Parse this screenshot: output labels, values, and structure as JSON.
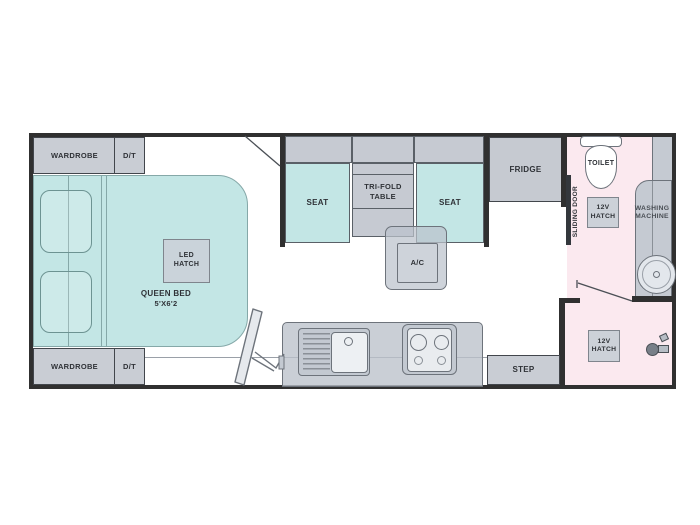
{
  "labels": {
    "wardrobe_top": "WARDROBE",
    "dt_top": "D/T",
    "wardrobe_bottom": "WARDROBE",
    "dt_bottom": "D/T",
    "queen_bed_line1": "QUEEN BED",
    "queen_bed_line2": "5'X6'2",
    "led_hatch_line1": "LED",
    "led_hatch_line2": "HATCH",
    "seat_left": "SEAT",
    "seat_right": "SEAT",
    "table_line1": "TRI-FOLD",
    "table_line2": "TABLE",
    "ac": "A/C",
    "fridge": "FRIDGE",
    "sliding_door": "SLIDING DOOR",
    "toilet": "TOILET",
    "hatch_bath_line1": "12V",
    "hatch_bath_line2": "HATCH",
    "washing_line1": "WASHING",
    "washing_line2": "MACHINE",
    "hatch_shower_line1": "12V",
    "hatch_shower_line2": "HATCH",
    "step": "STEP"
  },
  "colors": {
    "wall": "#303030",
    "cabinet_gray": "#c9cdd4",
    "upholstery_teal": "#c3e6e5",
    "wet_room_pink": "#fbe9ef",
    "text": "#2f3237"
  }
}
